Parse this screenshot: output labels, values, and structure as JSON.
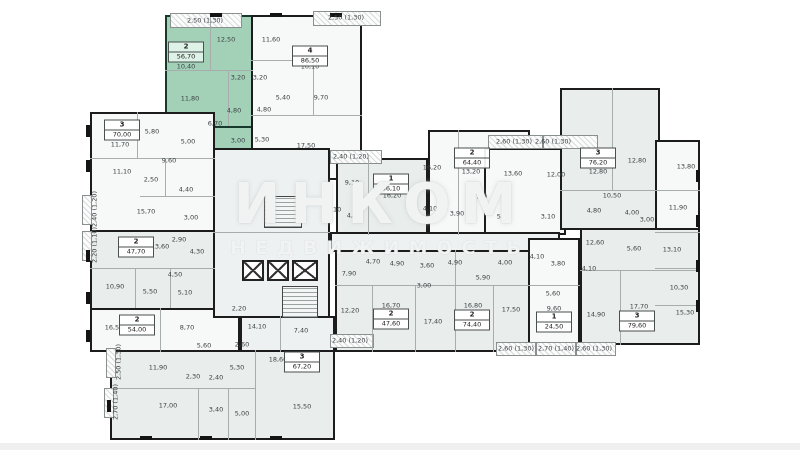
{
  "plan": {
    "watermark": {
      "line1": "ИНКОМ",
      "line2": "НЕДВИЖИМОСТЬ"
    },
    "colors": {
      "highlight": "#a2d1b8",
      "wall": "#1c1c1c",
      "room_white": "#f7f8f8",
      "room_gray": "#e9edec"
    },
    "highlighted_apartment": {
      "num": "2",
      "area": "56,70"
    },
    "apartments": [
      {
        "num": "2",
        "area": "56,70",
        "x": 186,
        "y": 52,
        "hl": true
      },
      {
        "num": "4",
        "area": "86,50",
        "x": 310,
        "y": 56
      },
      {
        "num": "3",
        "area": "70,00",
        "x": 122,
        "y": 130
      },
      {
        "num": "2",
        "area": "47,70",
        "x": 136,
        "y": 247
      },
      {
        "num": "2",
        "area": "54,00",
        "x": 137,
        "y": 325
      },
      {
        "num": "3",
        "area": "67,20",
        "x": 302,
        "y": 362
      },
      {
        "num": "1",
        "area": "36,10",
        "x": 391,
        "y": 184
      },
      {
        "num": "2",
        "area": "64,40",
        "x": 472,
        "y": 158
      },
      {
        "num": "3",
        "area": "76,20",
        "x": 598,
        "y": 158
      },
      {
        "num": "2",
        "area": "47,60",
        "x": 391,
        "y": 319
      },
      {
        "num": "2",
        "area": "74,40",
        "x": 472,
        "y": 320
      },
      {
        "num": "1",
        "area": "24,50",
        "x": 554,
        "y": 322
      },
      {
        "num": "3",
        "area": "79,60",
        "x": 637,
        "y": 321
      }
    ],
    "room_labels": [
      {
        "t": "12,50",
        "x": 226,
        "y": 40
      },
      {
        "t": "10,40",
        "x": 186,
        "y": 67
      },
      {
        "t": "11,80",
        "x": 190,
        "y": 99
      },
      {
        "t": "3,20",
        "x": 238,
        "y": 78
      },
      {
        "t": "4,80",
        "x": 234,
        "y": 111
      },
      {
        "t": "6,70",
        "x": 215,
        "y": 124
      },
      {
        "t": "3,00",
        "x": 238,
        "y": 141
      },
      {
        "t": "11,60",
        "x": 271,
        "y": 40
      },
      {
        "t": "3,20",
        "x": 260,
        "y": 78
      },
      {
        "t": "5,40",
        "x": 283,
        "y": 98
      },
      {
        "t": "4,80",
        "x": 264,
        "y": 110
      },
      {
        "t": "5,30",
        "x": 262,
        "y": 140
      },
      {
        "t": "9,70",
        "x": 321,
        "y": 98
      },
      {
        "t": "10,10",
        "x": 310,
        "y": 67
      },
      {
        "t": "17,50",
        "x": 306,
        "y": 146
      },
      {
        "t": "2,50 (1,30)",
        "x": 205,
        "y": 21,
        "b": 1
      },
      {
        "t": "2,50 (1,30)",
        "x": 346,
        "y": 18,
        "b": 1
      },
      {
        "t": "11,70",
        "x": 120,
        "y": 145
      },
      {
        "t": "5,80",
        "x": 152,
        "y": 132
      },
      {
        "t": "5,00",
        "x": 188,
        "y": 142
      },
      {
        "t": "9,60",
        "x": 169,
        "y": 161
      },
      {
        "t": "11,10",
        "x": 122,
        "y": 172
      },
      {
        "t": "2,50",
        "x": 151,
        "y": 180
      },
      {
        "t": "4,40",
        "x": 186,
        "y": 190
      },
      {
        "t": "15,70",
        "x": 146,
        "y": 212
      },
      {
        "t": "3,00",
        "x": 191,
        "y": 218
      },
      {
        "t": "13,60",
        "x": 160,
        "y": 247
      },
      {
        "t": "2,90",
        "x": 179,
        "y": 240
      },
      {
        "t": "4,30",
        "x": 197,
        "y": 252
      },
      {
        "t": "10,90",
        "x": 115,
        "y": 287
      },
      {
        "t": "5,50",
        "x": 150,
        "y": 292
      },
      {
        "t": "5,10",
        "x": 185,
        "y": 293
      },
      {
        "t": "4,50",
        "x": 175,
        "y": 275
      },
      {
        "t": "16,50",
        "x": 114,
        "y": 328
      },
      {
        "t": "8,70",
        "x": 187,
        "y": 328
      },
      {
        "t": "11,90",
        "x": 158,
        "y": 368
      },
      {
        "t": "2,30",
        "x": 193,
        "y": 377
      },
      {
        "t": "2,40",
        "x": 216,
        "y": 378
      },
      {
        "t": "5,60",
        "x": 204,
        "y": 346
      },
      {
        "t": "5,30",
        "x": 237,
        "y": 368
      },
      {
        "t": "17,00",
        "x": 168,
        "y": 406
      },
      {
        "t": "3,40",
        "x": 216,
        "y": 410
      },
      {
        "t": "5,00",
        "x": 242,
        "y": 414
      },
      {
        "t": "15,50",
        "x": 302,
        "y": 407
      },
      {
        "t": "18,60",
        "x": 278,
        "y": 360
      },
      {
        "t": "2,60",
        "x": 242,
        "y": 345
      },
      {
        "t": "2,20",
        "x": 239,
        "y": 309
      },
      {
        "t": "14,10",
        "x": 257,
        "y": 327
      },
      {
        "t": "7,40",
        "x": 301,
        "y": 331
      },
      {
        "t": "9,10",
        "x": 352,
        "y": 183
      },
      {
        "t": "16,20",
        "x": 392,
        "y": 196
      },
      {
        "t": "4,50",
        "x": 354,
        "y": 216
      },
      {
        "t": "5,10",
        "x": 334,
        "y": 210
      },
      {
        "t": "16,20",
        "x": 432,
        "y": 168
      },
      {
        "t": "13,20",
        "x": 471,
        "y": 172
      },
      {
        "t": "7,20",
        "x": 480,
        "y": 197
      },
      {
        "t": "4,10",
        "x": 430,
        "y": 209
      },
      {
        "t": "3,90",
        "x": 457,
        "y": 214
      },
      {
        "t": "5,80",
        "x": 504,
        "y": 217
      },
      {
        "t": "3,10",
        "x": 548,
        "y": 217
      },
      {
        "t": "13,60",
        "x": 513,
        "y": 174
      },
      {
        "t": "12,00",
        "x": 556,
        "y": 175
      },
      {
        "t": "2,40 (1,20)",
        "x": 351,
        "y": 157,
        "b": 1
      },
      {
        "t": "2,60 (1,30)",
        "x": 514,
        "y": 142,
        "b": 1
      },
      {
        "t": "2,60 (1,30)",
        "x": 553,
        "y": 142,
        "b": 1
      },
      {
        "t": "12,80",
        "x": 598,
        "y": 172
      },
      {
        "t": "12,80",
        "x": 637,
        "y": 161
      },
      {
        "t": "10,50",
        "x": 612,
        "y": 196
      },
      {
        "t": "4,80",
        "x": 594,
        "y": 211
      },
      {
        "t": "4,00",
        "x": 632,
        "y": 213
      },
      {
        "t": "3,00",
        "x": 647,
        "y": 220
      },
      {
        "t": "11,90",
        "x": 678,
        "y": 208
      },
      {
        "t": "13,80",
        "x": 686,
        "y": 167
      },
      {
        "t": "13,10",
        "x": 672,
        "y": 250
      },
      {
        "t": "10,30",
        "x": 679,
        "y": 288
      },
      {
        "t": "15,30",
        "x": 685,
        "y": 313
      },
      {
        "t": "12,60",
        "x": 595,
        "y": 243
      },
      {
        "t": "4,10",
        "x": 589,
        "y": 269
      },
      {
        "t": "5,60",
        "x": 634,
        "y": 249
      },
      {
        "t": "7,90",
        "x": 349,
        "y": 274
      },
      {
        "t": "3,00",
        "x": 424,
        "y": 286
      },
      {
        "t": "12,20",
        "x": 350,
        "y": 311
      },
      {
        "t": "16,70",
        "x": 391,
        "y": 306
      },
      {
        "t": "17,40",
        "x": 433,
        "y": 322
      },
      {
        "t": "16,80",
        "x": 473,
        "y": 306
      },
      {
        "t": "17,50",
        "x": 511,
        "y": 310
      },
      {
        "t": "4,70",
        "x": 373,
        "y": 262
      },
      {
        "t": "4,90",
        "x": 397,
        "y": 264
      },
      {
        "t": "3,60",
        "x": 427,
        "y": 266
      },
      {
        "t": "4,90",
        "x": 455,
        "y": 263
      },
      {
        "t": "4,00",
        "x": 505,
        "y": 263
      },
      {
        "t": "5,90",
        "x": 483,
        "y": 278
      },
      {
        "t": "4,10",
        "x": 537,
        "y": 257
      },
      {
        "t": "3,80",
        "x": 558,
        "y": 264
      },
      {
        "t": "5,60",
        "x": 553,
        "y": 294
      },
      {
        "t": "9,60",
        "x": 554,
        "y": 309
      },
      {
        "t": "14,90",
        "x": 596,
        "y": 315
      },
      {
        "t": "17,70",
        "x": 639,
        "y": 307
      },
      {
        "t": "2,40 (1,20)",
        "x": 350,
        "y": 341,
        "b": 1
      },
      {
        "t": "2,60 (1,30)",
        "x": 516,
        "y": 349,
        "b": 1
      },
      {
        "t": "2,70 (1,40)",
        "x": 556,
        "y": 349,
        "b": 1
      },
      {
        "t": "2,60 (1,30)",
        "x": 594,
        "y": 349,
        "b": 1
      },
      {
        "t": "2,40 (1,20)",
        "x": 95,
        "y": 209,
        "b": 1,
        "r": 1
      },
      {
        "t": "2,20 (1,10)",
        "x": 95,
        "y": 245,
        "b": 1,
        "r": 1
      },
      {
        "t": "2,50 (1,30)",
        "x": 119,
        "y": 362,
        "b": 1,
        "r": 1
      },
      {
        "t": "2,70 (1,40)",
        "x": 116,
        "y": 402,
        "b": 1,
        "r": 1
      }
    ]
  }
}
